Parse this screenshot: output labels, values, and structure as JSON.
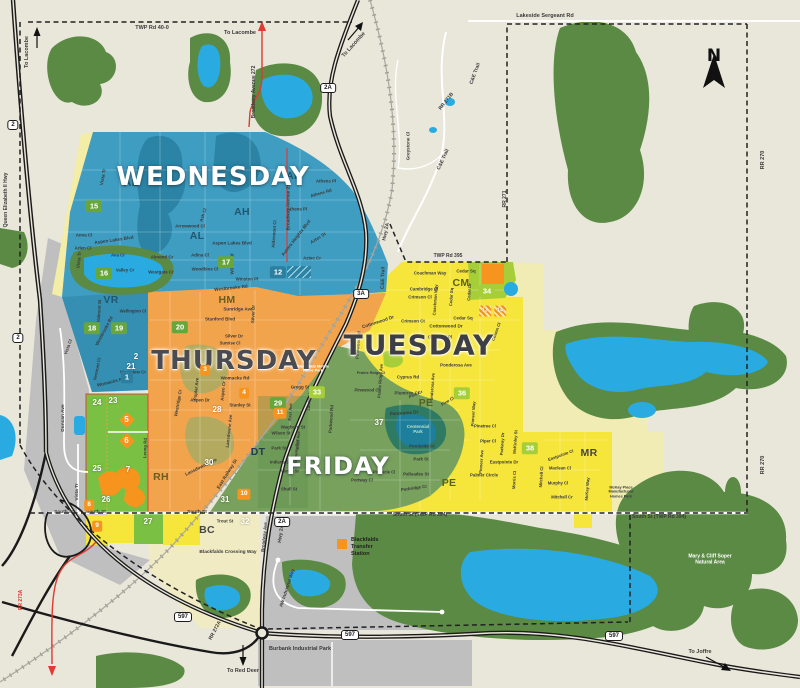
{
  "colors": {
    "bg": "#e9e6da",
    "forest": "#5a8a43",
    "lake": "#29abe2",
    "pond": "#1d7f9c",
    "wed": "#3f9dc2",
    "wedDark": "#2b84a6",
    "thu": "#f2a44c",
    "thuDark": "#ea9430",
    "fri": "#78a15d",
    "friDark": "#5d8c50",
    "parkGreen": "#2e7a62",
    "bgreen": "#7ac143",
    "lime": "#a6ce39",
    "obox": "#f7941e",
    "yellow": "#f6e53a",
    "paleYellow": "#f0ecb4",
    "cream": "#f0ebc2",
    "gray": "#bfbfc0",
    "khaki": "#b3a95f",
    "red": "#e03a32",
    "roadBlack": "#1a1a1a",
    "textDark": "#3a3a3a"
  },
  "compass": {
    "label": "N"
  },
  "legend": {
    "label": "Blackfalds\nTransfer\nStation"
  },
  "day_labels": [
    {
      "t": "WEDNESDAY",
      "x": 213,
      "y": 177,
      "s": 26,
      "c": "#ffffff",
      "cls": "halo-dark",
      "n": "day-label-wednesday"
    },
    {
      "t": "THURSDAY",
      "x": 234,
      "y": 361,
      "s": 26,
      "c": "#4b4b52",
      "cls": "halo-light",
      "n": "day-label-thursday"
    },
    {
      "t": "TUESDAY",
      "x": 419,
      "y": 345,
      "s": 28,
      "c": "#3e3e46",
      "cls": "halo-light",
      "n": "day-label-tuesday"
    },
    {
      "t": "FRIDAY",
      "x": 338,
      "y": 466,
      "s": 24,
      "c": "#ffffff",
      "cls": "halo-dark",
      "n": "day-label-friday"
    }
  ],
  "area_labels": [
    {
      "t": "AL",
      "x": 131,
      "y": 183,
      "c": "#1f586f"
    },
    {
      "t": "AL",
      "x": 197,
      "y": 236,
      "c": "#1f586f"
    },
    {
      "t": "AH",
      "x": 294,
      "y": 176,
      "c": "#1f586f"
    },
    {
      "t": "AH",
      "x": 242,
      "y": 212,
      "c": "#1f586f"
    },
    {
      "t": "VR",
      "x": 111,
      "y": 300,
      "c": "#1f586f"
    },
    {
      "t": "HM",
      "x": 227,
      "y": 300,
      "c": "#6d5c22"
    },
    {
      "t": "RH",
      "x": 161,
      "y": 477,
      "c": "#6d5c22"
    },
    {
      "t": "DT",
      "x": 258,
      "y": 452,
      "c": "#1e3a55"
    },
    {
      "t": "PE",
      "x": 426,
      "y": 403,
      "c": "#55631f"
    },
    {
      "t": "PE",
      "x": 449,
      "y": 483,
      "c": "#55631f"
    },
    {
      "t": "CM",
      "x": 461,
      "y": 283,
      "c": "#55631f"
    },
    {
      "t": "MR",
      "x": 589,
      "y": 453,
      "c": "#454545"
    },
    {
      "t": "BC",
      "x": 207,
      "y": 530,
      "c": "#454545"
    }
  ],
  "street_labels": [
    {
      "t": "TWP Rd 40-0",
      "x": 152,
      "y": 28,
      "s": 5.5
    },
    {
      "t": "To Lacombe",
      "x": 240,
      "y": 33,
      "s": 5.5
    },
    {
      "t": "To Lacombe",
      "x": 27,
      "y": 52,
      "r": -90,
      "s": 5.5
    },
    {
      "t": "To Lacombe",
      "x": 354,
      "y": 45,
      "r": -48,
      "s": 5.5
    },
    {
      "t": "Lakeside Sergeant Rd",
      "x": 545,
      "y": 16,
      "s": 5.5
    },
    {
      "t": "Broadway Avenue 272",
      "x": 255,
      "y": 92,
      "r": -90,
      "s": 5
    },
    {
      "t": "Broadway Avenue 272",
      "x": 288,
      "y": 206,
      "r": -90,
      "s": 4.6
    },
    {
      "t": "Queen Elizabeth II Hwy",
      "x": 7,
      "y": 200,
      "r": -90,
      "s": 5
    },
    {
      "t": "RR 271B",
      "x": 447,
      "y": 102,
      "r": -52,
      "s": 5
    },
    {
      "t": "C&E Trail",
      "x": 476,
      "y": 74,
      "r": -70,
      "s": 5
    },
    {
      "t": "C&E Trail",
      "x": 444,
      "y": 160,
      "r": -65,
      "s": 5
    },
    {
      "t": "C&E Trail",
      "x": 384,
      "y": 278,
      "r": -88,
      "s": 5
    },
    {
      "t": "Greystone Cl",
      "x": 408,
      "y": 146,
      "r": -90,
      "s": 4.6
    },
    {
      "t": "RR 270",
      "x": 763,
      "y": 160,
      "r": -90,
      "s": 5.5
    },
    {
      "t": "RR 270",
      "x": 763,
      "y": 465,
      "r": -90,
      "s": 5.5
    },
    {
      "t": "RR 271",
      "x": 506,
      "y": 199,
      "r": -90,
      "s": 5
    },
    {
      "t": "Hwy 2A",
      "x": 387,
      "y": 232,
      "r": -78,
      "s": 5
    },
    {
      "t": "Hwy 2A",
      "x": 282,
      "y": 534,
      "r": -82,
      "s": 5
    },
    {
      "t": "TWP Rd 395",
      "x": 448,
      "y": 257,
      "s": 5
    },
    {
      "t": "RR 272A",
      "x": 216,
      "y": 631,
      "r": -62,
      "s": 5
    },
    {
      "t": "RR 273A",
      "x": 22,
      "y": 600,
      "r": -90,
      "s": 5,
      "c": "#d63a32"
    },
    {
      "t": "South St",
      "x": 64,
      "y": 513,
      "s": 4.8
    },
    {
      "t": "South St",
      "x": 96,
      "y": 513,
      "s": 4.8
    },
    {
      "t": "South St",
      "x": 197,
      "y": 513,
      "s": 4.8
    },
    {
      "t": "South St (TWP Rd 394)",
      "x": 420,
      "y": 516,
      "s": 5
    },
    {
      "t": "South St (TWP Rd 394)",
      "x": 659,
      "y": 518,
      "s": 5
    },
    {
      "t": "Blackfalds Crossing Way",
      "x": 228,
      "y": 553,
      "s": 4.8
    },
    {
      "t": "Burbank Industrial Park",
      "x": 300,
      "y": 649,
      "s": 5.5
    },
    {
      "t": "To Red Deer",
      "x": 243,
      "y": 671,
      "s": 5.5
    },
    {
      "t": "To Joffre",
      "x": 700,
      "y": 652,
      "s": 5.5
    },
    {
      "t": "Mary & Cliff Soper\nNatural Area",
      "x": 710,
      "y": 560,
      "s": 5,
      "c": "#ffffff"
    },
    {
      "t": "Blackfalds Mobile\nHome Park",
      "x": 313,
      "y": 369,
      "s": 3.8,
      "c": "#ffffff"
    },
    {
      "t": "McKay Place\nManufactured\nHomes Park",
      "x": 621,
      "y": 492,
      "s": 3.8
    },
    {
      "t": "Duncan Ave",
      "x": 64,
      "y": 418,
      "r": -90,
      "s": 4.8
    },
    {
      "t": "Vista Tr",
      "x": 78,
      "y": 492,
      "r": -90,
      "s": 4.8
    },
    {
      "t": "AW Industrial Way",
      "x": 287,
      "y": 588,
      "r": -72,
      "s": 4.6
    },
    {
      "t": "Trout St",
      "x": 225,
      "y": 521,
      "s": 4.4
    },
    {
      "t": "Broadway Ave",
      "x": 264,
      "y": 537,
      "r": -84,
      "s": 4.4
    },
    {
      "t": "East Railway St",
      "x": 227,
      "y": 474,
      "r": -58,
      "s": 4.6
    },
    {
      "t": "Vista Tr",
      "x": 103,
      "y": 177,
      "r": -80,
      "s": 4.6
    },
    {
      "t": "Vista Tr",
      "x": 79,
      "y": 260,
      "r": -84,
      "s": 4.6
    },
    {
      "t": "Vista Cl",
      "x": 68,
      "y": 347,
      "r": -70,
      "s": 4.4
    },
    {
      "t": "Anna Cl",
      "x": 84,
      "y": 235,
      "s": 4.4
    },
    {
      "t": "Aspen Lakes Blvd",
      "x": 114,
      "y": 240,
      "r": -8,
      "s": 4.6
    },
    {
      "t": "Aspen Lakes Blvd",
      "x": 232,
      "y": 243,
      "s": 4.6
    },
    {
      "t": "Arlen Cl",
      "x": 83,
      "y": 248,
      "s": 4.4
    },
    {
      "t": "Ava Cr",
      "x": 118,
      "y": 255,
      "s": 4.4
    },
    {
      "t": "Valley Cr",
      "x": 125,
      "y": 270,
      "s": 4.4
    },
    {
      "t": "Almond Cr",
      "x": 162,
      "y": 257,
      "s": 4.4
    },
    {
      "t": "Adina Cl",
      "x": 200,
      "y": 255,
      "s": 4.4
    },
    {
      "t": "Woodbine Cl",
      "x": 205,
      "y": 269,
      "s": 4.4
    },
    {
      "t": "Westgate Cr",
      "x": 161,
      "y": 272,
      "s": 4.4
    },
    {
      "t": "Winston Pl",
      "x": 247,
      "y": 279,
      "s": 4.4
    },
    {
      "t": "Westbrooke Rd",
      "x": 231,
      "y": 288,
      "r": -6,
      "s": 4.6
    },
    {
      "t": "Willow Rd",
      "x": 232,
      "y": 264,
      "r": -90,
      "s": 4.4
    },
    {
      "t": "Arrowwood Cl",
      "x": 190,
      "y": 226,
      "s": 4.4
    },
    {
      "t": "Ash Cl",
      "x": 203,
      "y": 215,
      "r": -72,
      "s": 4.4
    },
    {
      "t": "Valmont St",
      "x": 99,
      "y": 311,
      "r": -86,
      "s": 4.4
    },
    {
      "t": "Vermont Cl",
      "x": 97,
      "y": 369,
      "r": -78,
      "s": 4.4
    },
    {
      "t": "Westbrooke Rd",
      "x": 104,
      "y": 331,
      "r": -62,
      "s": 4.4
    },
    {
      "t": "Athens Pl",
      "x": 326,
      "y": 181,
      "s": 4.4
    },
    {
      "t": "Athens Rd",
      "x": 321,
      "y": 193,
      "r": -16,
      "s": 4.4
    },
    {
      "t": "Athens Pl",
      "x": 297,
      "y": 209,
      "s": 4.4
    },
    {
      "t": "Aurora Heights Blvd",
      "x": 296,
      "y": 238,
      "r": -52,
      "s": 4.6
    },
    {
      "t": "Aztec St",
      "x": 318,
      "y": 238,
      "r": -32,
      "s": 4.4
    },
    {
      "t": "Aztec Cr",
      "x": 312,
      "y": 258,
      "s": 4.4
    },
    {
      "t": "Aldermont Cl",
      "x": 274,
      "y": 234,
      "r": -86,
      "s": 4.4
    },
    {
      "t": "Sunridge Ave",
      "x": 238,
      "y": 309,
      "s": 4.6
    },
    {
      "t": "Stanford Blvd",
      "x": 220,
      "y": 319,
      "s": 4.6
    },
    {
      "t": "Silver Dr",
      "x": 253,
      "y": 314,
      "r": -88,
      "s": 4.4
    },
    {
      "t": "Silver Dr",
      "x": 234,
      "y": 336,
      "s": 4.4
    },
    {
      "t": "Sunrise Cl",
      "x": 230,
      "y": 344,
      "s": 4.2
    },
    {
      "t": "Wellington Cl",
      "x": 133,
      "y": 312,
      "s": 4.2
    },
    {
      "t": "Westview Cr",
      "x": 133,
      "y": 372,
      "s": 4.4
    },
    {
      "t": "Womacks Rd",
      "x": 235,
      "y": 378,
      "s": 4.6
    },
    {
      "t": "Womacks Rd",
      "x": 111,
      "y": 382,
      "r": -14,
      "s": 4.6
    },
    {
      "t": "Aspen Dr",
      "x": 200,
      "y": 400,
      "s": 4.4
    },
    {
      "t": "Poplar Ave",
      "x": 196,
      "y": 389,
      "r": -84,
      "s": 4.4
    },
    {
      "t": "Aspen Cr",
      "x": 223,
      "y": 391,
      "r": -84,
      "s": 4.4
    },
    {
      "t": "Stanley St",
      "x": 240,
      "y": 405,
      "s": 4.4
    },
    {
      "t": "Westridge Cr",
      "x": 178,
      "y": 403,
      "r": -80,
      "s": 4.4
    },
    {
      "t": "Lansdowne Ave",
      "x": 201,
      "y": 467,
      "r": -26,
      "s": 4.6
    },
    {
      "t": "Lansdowne Ave",
      "x": 229,
      "y": 431,
      "r": -84,
      "s": 4.4
    },
    {
      "t": "Leung Rd",
      "x": 145,
      "y": 448,
      "r": -88,
      "s": 4.4
    },
    {
      "t": "Gregg St",
      "x": 300,
      "y": 387,
      "s": 4.4
    },
    {
      "t": "Waghorn St",
      "x": 293,
      "y": 427,
      "s": 4.4
    },
    {
      "t": "Wilson St",
      "x": 281,
      "y": 434,
      "s": 4.2
    },
    {
      "t": "Park St",
      "x": 279,
      "y": 448,
      "s": 4.4
    },
    {
      "t": "East Ave",
      "x": 291,
      "y": 412,
      "r": -86,
      "s": 4.2
    },
    {
      "t": "East Ave",
      "x": 299,
      "y": 440,
      "r": -86,
      "s": 4.2
    },
    {
      "t": "Lawton Ave",
      "x": 310,
      "y": 399,
      "r": -86,
      "s": 4.2
    },
    {
      "t": "Indiana St",
      "x": 280,
      "y": 463,
      "s": 4.2
    },
    {
      "t": "Winks St",
      "x": 290,
      "y": 472,
      "s": 4.2
    },
    {
      "t": "Shull St",
      "x": 289,
      "y": 489,
      "s": 4.4
    },
    {
      "t": "Highway Ave",
      "x": 297,
      "y": 452,
      "r": -86,
      "s": 4.2
    },
    {
      "t": "Panorama Dr",
      "x": 404,
      "y": 413,
      "r": -4,
      "s": 4.6
    },
    {
      "t": "Centennial\nPark",
      "x": 418,
      "y": 429,
      "s": 4.4,
      "c": "#bfe0c2"
    },
    {
      "t": "Pondside Cr",
      "x": 422,
      "y": 446,
      "s": 4.4
    },
    {
      "t": "Park St",
      "x": 421,
      "y": 459,
      "s": 4.4
    },
    {
      "t": "Palisades St",
      "x": 416,
      "y": 474,
      "s": 4.4
    },
    {
      "t": "Parkridge Cr",
      "x": 414,
      "y": 488,
      "r": -8,
      "s": 4.4
    },
    {
      "t": "Pinnacle Cl",
      "x": 384,
      "y": 473,
      "s": 4.2
    },
    {
      "t": "Portway Cl",
      "x": 362,
      "y": 481,
      "s": 4.2
    },
    {
      "t": "Parkwood Rd",
      "x": 331,
      "y": 419,
      "r": -86,
      "s": 4.4
    },
    {
      "t": "Pinewood Rd",
      "x": 358,
      "y": 345,
      "r": -86,
      "s": 4.4
    },
    {
      "t": "Coachman Way",
      "x": 430,
      "y": 273,
      "s": 4.4
    },
    {
      "t": "Cedar Sq",
      "x": 466,
      "y": 271,
      "s": 4.4
    },
    {
      "t": "Cambridge Cl",
      "x": 424,
      "y": 289,
      "s": 4.4
    },
    {
      "t": "Crimson Cl",
      "x": 420,
      "y": 297,
      "s": 4.4
    },
    {
      "t": "Crimson Ct",
      "x": 413,
      "y": 321,
      "s": 4.4
    },
    {
      "t": "Coachman Way",
      "x": 436,
      "y": 300,
      "r": -86,
      "s": 4.2
    },
    {
      "t": "Cedar Sq",
      "x": 452,
      "y": 297,
      "r": -86,
      "s": 4.2
    },
    {
      "t": "Cedar Dr",
      "x": 470,
      "y": 292,
      "r": -86,
      "s": 4.2
    },
    {
      "t": "Cedar Sq",
      "x": 463,
      "y": 318,
      "s": 4.4
    },
    {
      "t": "Cottonwood Dr",
      "x": 378,
      "y": 322,
      "r": -18,
      "s": 4.6
    },
    {
      "t": "Cottonwood Dr",
      "x": 446,
      "y": 326,
      "s": 4.6
    },
    {
      "t": "Churchill Pl",
      "x": 440,
      "y": 337,
      "s": 4.4
    },
    {
      "t": "Cowan Cl",
      "x": 497,
      "y": 332,
      "r": -70,
      "s": 4.2
    },
    {
      "t": "Cyprus Rd",
      "x": 408,
      "y": 377,
      "s": 4.4
    },
    {
      "t": "Plumtree Cr",
      "x": 407,
      "y": 393,
      "s": 4.4
    },
    {
      "t": "Ponderosa Ave",
      "x": 456,
      "y": 365,
      "s": 4.4
    },
    {
      "t": "Ponderosa Ave",
      "x": 433,
      "y": 388,
      "r": -86,
      "s": 4.2
    },
    {
      "t": "Pine Cr",
      "x": 416,
      "y": 395,
      "r": -24,
      "s": 4.2
    },
    {
      "t": "Pine Cl",
      "x": 448,
      "y": 402,
      "r": -30,
      "s": 4.2
    },
    {
      "t": "Prairie Ridge Ave",
      "x": 381,
      "y": 381,
      "r": -86,
      "s": 4.2
    },
    {
      "t": "Prairie Ridge Cl",
      "x": 371,
      "y": 373,
      "s": 3.8
    },
    {
      "t": "Pinewood Cl",
      "x": 367,
      "y": 391,
      "s": 4.2
    },
    {
      "t": "Pioneer Way",
      "x": 474,
      "y": 414,
      "r": -86,
      "s": 4.2
    },
    {
      "t": "Pinetree Cl",
      "x": 485,
      "y": 427,
      "s": 4.2
    },
    {
      "t": "Piper Cl",
      "x": 488,
      "y": 442,
      "s": 4.2
    },
    {
      "t": "Pioneer Ave",
      "x": 482,
      "y": 462,
      "r": -86,
      "s": 4.2
    },
    {
      "t": "Parkway Dr",
      "x": 503,
      "y": 444,
      "r": -86,
      "s": 4.2
    },
    {
      "t": "McKinley St",
      "x": 516,
      "y": 442,
      "r": -86,
      "s": 4.2
    },
    {
      "t": "Eastpointe Dr",
      "x": 504,
      "y": 462,
      "s": 4.4
    },
    {
      "t": "Palmer Circle",
      "x": 484,
      "y": 475,
      "s": 4.4
    },
    {
      "t": "Morris Cl",
      "x": 515,
      "y": 480,
      "r": -86,
      "s": 4.2
    },
    {
      "t": "Mitchell Cl",
      "x": 542,
      "y": 477,
      "r": -86,
      "s": 4.2
    },
    {
      "t": "Murphy Cl",
      "x": 558,
      "y": 484,
      "s": 4.2
    },
    {
      "t": "Maclean Cl",
      "x": 560,
      "y": 469,
      "s": 4.2
    },
    {
      "t": "Eastpointe Cl",
      "x": 561,
      "y": 456,
      "r": -20,
      "s": 4.2
    },
    {
      "t": "Mitchell Cr",
      "x": 562,
      "y": 498,
      "s": 4.2
    },
    {
      "t": "McKay Way",
      "x": 588,
      "y": 489,
      "r": -86,
      "s": 4.2
    }
  ],
  "zone_numbers": [
    {
      "n": "15",
      "x": 94,
      "y": 206,
      "style": "green"
    },
    {
      "n": "16",
      "x": 104,
      "y": 273,
      "style": "green"
    },
    {
      "n": "17",
      "x": 226,
      "y": 262,
      "style": "green"
    },
    {
      "n": "12",
      "x": 278,
      "y": 272,
      "style": "teal"
    },
    {
      "n": "18",
      "x": 92,
      "y": 328,
      "style": "green"
    },
    {
      "n": "19",
      "x": 119,
      "y": 328,
      "style": "green"
    },
    {
      "n": "20",
      "x": 180,
      "y": 327,
      "style": "green"
    },
    {
      "n": "2",
      "x": 136,
      "y": 357,
      "style": "plain"
    },
    {
      "n": "21",
      "x": 131,
      "y": 367,
      "style": "plain"
    },
    {
      "n": "1",
      "x": 127,
      "y": 377,
      "style": "teal"
    },
    {
      "n": "24",
      "x": 97,
      "y": 403,
      "style": "plain"
    },
    {
      "n": "23",
      "x": 113,
      "y": 401,
      "style": "plain"
    },
    {
      "n": "25",
      "x": 97,
      "y": 469,
      "style": "plain"
    },
    {
      "n": "26",
      "x": 106,
      "y": 500,
      "style": "plain"
    },
    {
      "n": "5",
      "x": 127,
      "y": 420,
      "style": "diamond"
    },
    {
      "n": "6",
      "x": 127,
      "y": 441,
      "style": "diamond"
    },
    {
      "n": "7",
      "x": 128,
      "y": 470,
      "style": "plain"
    },
    {
      "n": "8",
      "x": 89,
      "y": 505,
      "style": "obox"
    },
    {
      "n": "9",
      "x": 97,
      "y": 526,
      "style": "obox"
    },
    {
      "n": "27",
      "x": 148,
      "y": 522,
      "style": "plain"
    },
    {
      "n": "3",
      "x": 205,
      "y": 370,
      "style": "obox"
    },
    {
      "n": "4",
      "x": 244,
      "y": 393,
      "style": "obox"
    },
    {
      "n": "28",
      "x": 217,
      "y": 410,
      "style": "plain"
    },
    {
      "n": "30",
      "x": 209,
      "y": 463,
      "style": "plain"
    },
    {
      "n": "29",
      "x": 278,
      "y": 403,
      "style": "green"
    },
    {
      "n": "11",
      "x": 280,
      "y": 413,
      "style": "obox"
    },
    {
      "n": "10",
      "x": 244,
      "y": 494,
      "style": "obox"
    },
    {
      "n": "31",
      "x": 225,
      "y": 500,
      "style": "plain"
    },
    {
      "n": "32",
      "x": 245,
      "y": 522,
      "style": "plain"
    },
    {
      "n": "33",
      "x": 317,
      "y": 392,
      "style": "lime"
    },
    {
      "n": "37",
      "x": 379,
      "y": 423,
      "style": "plain"
    },
    {
      "n": "36",
      "x": 462,
      "y": 393,
      "style": "lime"
    },
    {
      "n": "38",
      "x": 530,
      "y": 448,
      "style": "lime"
    },
    {
      "n": "34",
      "x": 487,
      "y": 291,
      "style": "lime"
    },
    {
      "n": "13",
      "x": 485,
      "y": 311,
      "style": "hatch"
    },
    {
      "n": "14",
      "x": 500,
      "y": 311,
      "style": "hatch"
    }
  ],
  "shields": [
    {
      "t": "2",
      "x": 13,
      "y": 125
    },
    {
      "t": "2",
      "x": 18,
      "y": 338
    },
    {
      "t": "2A",
      "x": 328,
      "y": 88
    },
    {
      "t": "3A",
      "x": 361,
      "y": 294
    },
    {
      "t": "2A",
      "x": 282,
      "y": 522
    },
    {
      "t": "597",
      "x": 183,
      "y": 617
    },
    {
      "t": "597",
      "x": 350,
      "y": 635
    },
    {
      "t": "597",
      "x": 614,
      "y": 636
    }
  ]
}
